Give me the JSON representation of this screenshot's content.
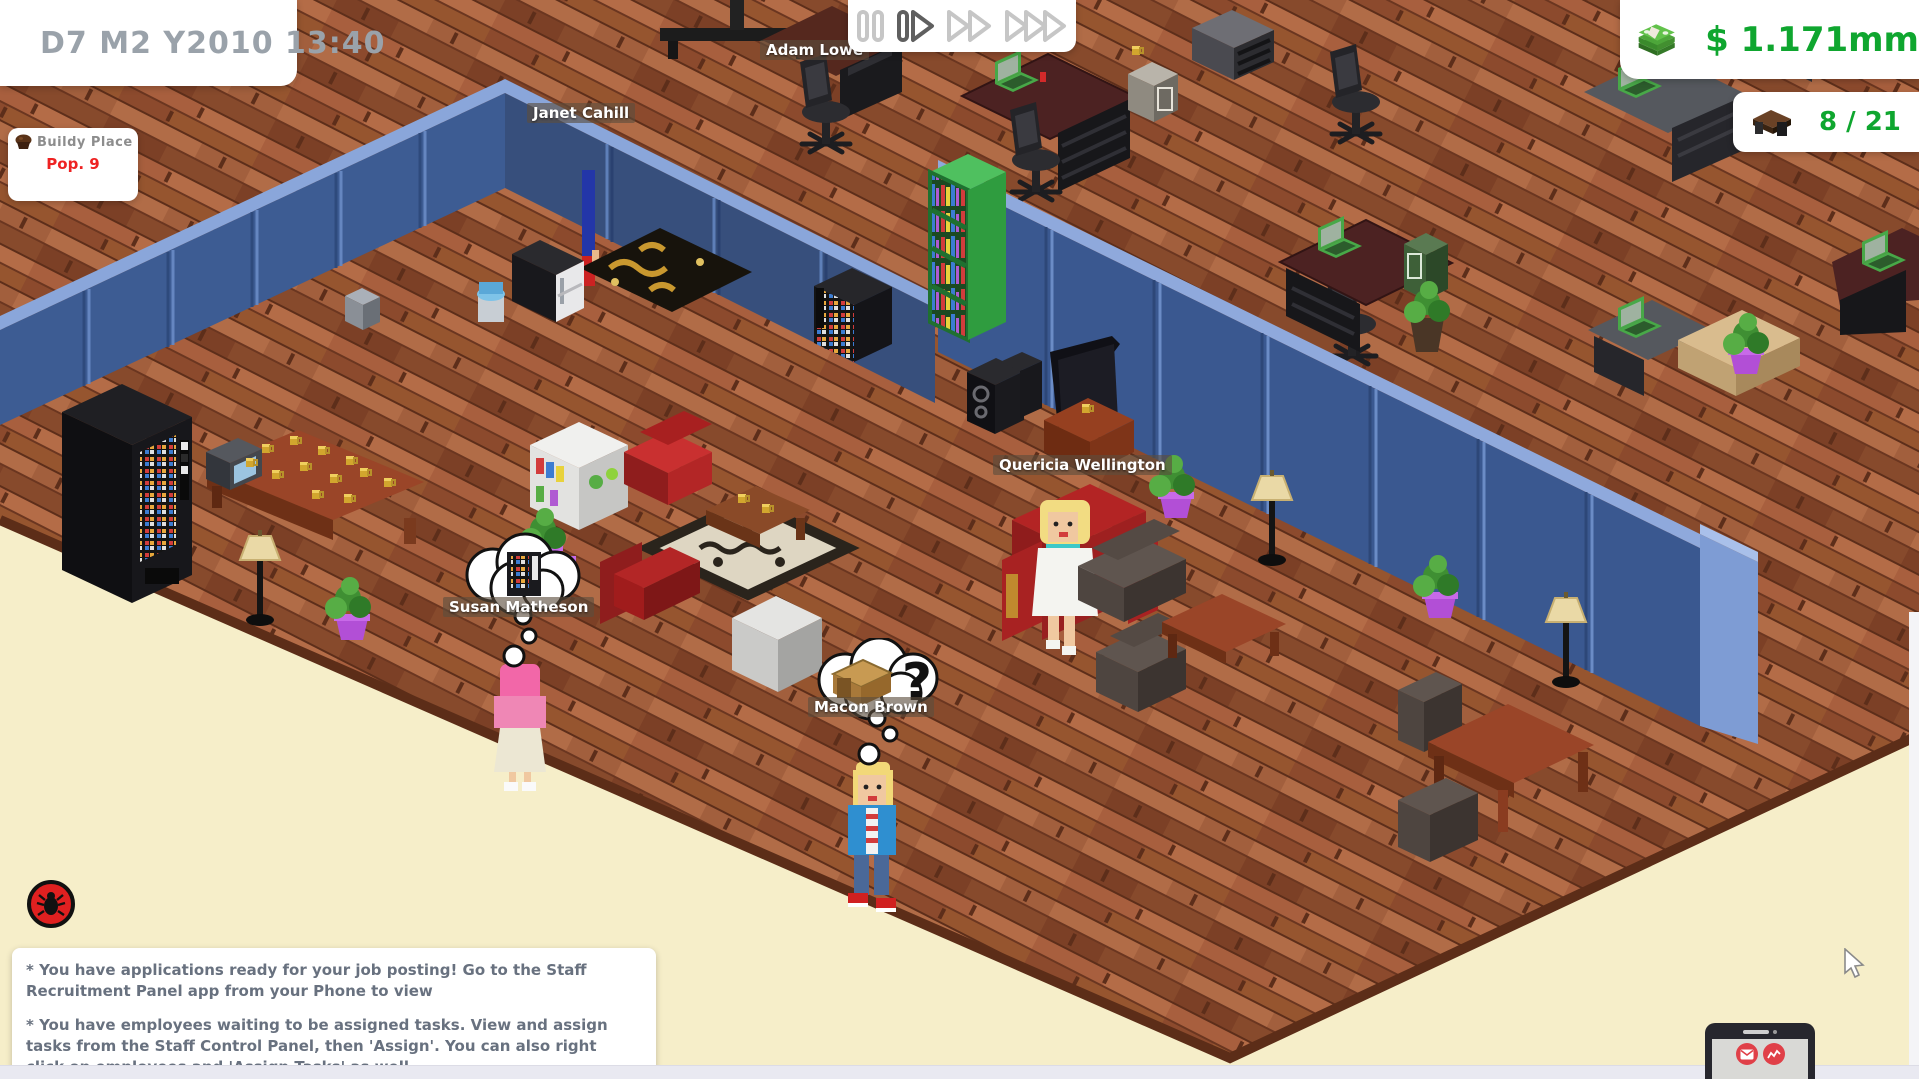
{
  "hud": {
    "date": "D7 M2 Y2010 13:40",
    "money": "$ 1.171mm",
    "desk_count": "8 / 21",
    "place_name": "Buildy Place",
    "population": "Pop. 9",
    "speed": {
      "active": "play",
      "options": [
        "pause",
        "play",
        "fast-forward",
        "fastest-forward"
      ]
    }
  },
  "characters": [
    {
      "name": "Adam Lowe"
    },
    {
      "name": "Janet Cahill"
    },
    {
      "name": "Quericia Wellington"
    },
    {
      "name": "Susan Matheson",
      "thought": "vending-machine"
    },
    {
      "name": "Macon Brown",
      "thought": "desk",
      "bubble_text": "?"
    }
  ],
  "notifications": [
    "* You have applications ready for your job posting! Go to the Staff Recruitment Panel app from your Phone to view",
    "* You have employees waiting to be assigned tasks. View and assign tasks from the Staff Control Panel, then 'Assign'. You can also right click on employees and 'Assign Tasks' as well."
  ],
  "colors": {
    "money_green": "#0fa62f",
    "pop_red": "#ee2222",
    "wall_blue": "#3a5890",
    "floor_brown": "#9c5736",
    "ground_cream": "#f6eec9",
    "hud_text_gray": "#9aa2aa",
    "notification_text": "#68717f"
  }
}
